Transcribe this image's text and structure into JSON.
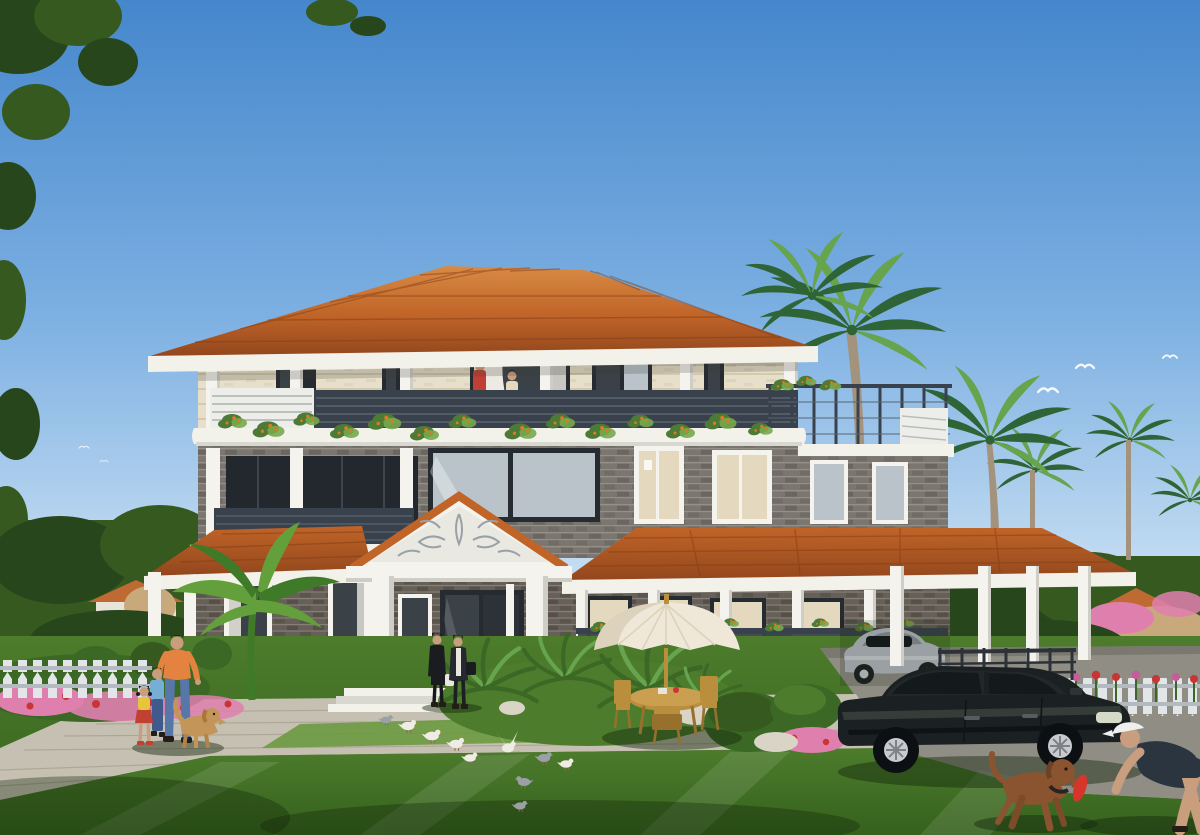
{
  "meta": {
    "type": "architectural-exterior-rendering",
    "subject": "three-storey tropical villa with terracotta hip roofs, grey brick walls, white columns and wrap-around verandas",
    "setting": "landscaped garden with palm trees, lawns, flower beds and picket fences under a clear blue sky"
  },
  "scene": {
    "building": {
      "floors": 3,
      "roof": "terracotta tile hip roof with white fascia",
      "walls": [
        "cream textured stone (top floor)",
        "grey brick (lower floors)"
      ],
      "features": [
        "entrance portico with carved pediment",
        "balcony with plant garland",
        "roof terrace with metal railing",
        "wrap-around porch",
        "carport"
      ]
    },
    "vehicles": [
      "black sedan on driveway",
      "silver sports car under carport"
    ],
    "people": [
      "man in orange shirt walking with two children and golden dog",
      "two women walking near entrance",
      "woman with child on balcony",
      "man in cap playing with brown dog"
    ],
    "animals": [
      "golden retriever",
      "brown dog with red frisbee",
      "flock of pigeons",
      "gulls in sky"
    ],
    "garden": [
      "banana plant",
      "cycads",
      "clipped shrubs",
      "pink and red flower beds",
      "white picket fences",
      "parasol with wooden table and chairs",
      "white rocks"
    ]
  },
  "palette": {
    "sky-top": "#4587cc",
    "sky-mid": "#7db0e2",
    "sky-low": "#c3dcf2",
    "sky-horizon": "#e4eff8",
    "roof-light": "#d98a44",
    "roof-main": "#c06428",
    "roof-dark": "#93471d",
    "roof-line": "#7e3a15",
    "fascia": "#f2f1ea",
    "fascia-shade": "#d9d8d0",
    "cream-wall": "#e7dfc9",
    "cream-line": "#d3c9ae",
    "brick-mid": "#7b766f",
    "brick-dark": "#615c55",
    "brick-mortar": "#948f87",
    "brick-first": "#676059",
    "brick-first-dark": "#4e4942",
    "brick-first-mortar": "#857f77",
    "frame-dark": "#262b31",
    "glass-cool": "#b9c3c9",
    "glass-warm": "#e4d9bf",
    "glass-dark": "#3a4147",
    "curtain": "#eceae2",
    "col-white": "#f4f3ee",
    "col-shade": "#cfcec6",
    "rail-dark": "#39424c",
    "rail-line": "#5a646e",
    "lattice-white": "#edeeea",
    "vine-green": "#4d7a35",
    "vine-light": "#77a94c",
    "vine-flower": "#e07a20",
    "lawn-light": "#6b9a40",
    "lawn-mid": "#4d7c2c",
    "lawn-dark": "#35611d",
    "plaza": "#c6c0b2",
    "plaza-line": "#a9a294",
    "drive": "#908d85",
    "drive-dark": "#7b7870",
    "stone-base": "#8a7e6e",
    "fence-white": "#e3e6e8",
    "fence-shade": "#b3bac0",
    "flower-pink": "#df7fae",
    "flower-red": "#c93434",
    "flower-magenta": "#c75b9b",
    "shrub": "#3c6825",
    "banana": "#63a03c",
    "banana-dark": "#3f7a28",
    "palm-dark": "#2f6436",
    "palm-light": "#66a44e",
    "palm-trunk": "#a4937c",
    "tree-dark": "#27461b",
    "tree-mid": "#35591f",
    "dist-roof": "#bf6a33",
    "dist-wall": "#e8e4da",
    "rock-tan": "#c8a97c",
    "rock-white": "#d9d4c6",
    "car-black": "#1b2023",
    "car-reflect": "#4a564c",
    "car-glass": "#14191c",
    "wheel-alloy": "#c8ccd0",
    "car-silver": "#b7bcc4",
    "car-silver-dark": "#8b9199",
    "wood": "#b98f3e",
    "wood-dark": "#96702c",
    "umbrella": "#efe8d8",
    "umbrella-shade": "#ddd2bc",
    "skin": "#c99e7e",
    "hair-dark": "#221d18",
    "shirt-orange": "#e4823f",
    "jeans": "#5677a8",
    "boy-blue": "#77aed6",
    "girl-yellow": "#e6c43b",
    "girl-red": "#c04034",
    "coat-black": "#1b1c20",
    "coat-dark": "#26292e",
    "scarf-white": "#e9e7df",
    "dog-gold": "#c49559",
    "dog-brown": "#8a5430",
    "frisbee": "#d8352a",
    "cap-white": "#eef0ef",
    "man-navy": "#2b3540",
    "pigeon-white": "#efece4",
    "pigeon-gray": "#9aa0a6",
    "bird-white": "#f6fafd"
  }
}
